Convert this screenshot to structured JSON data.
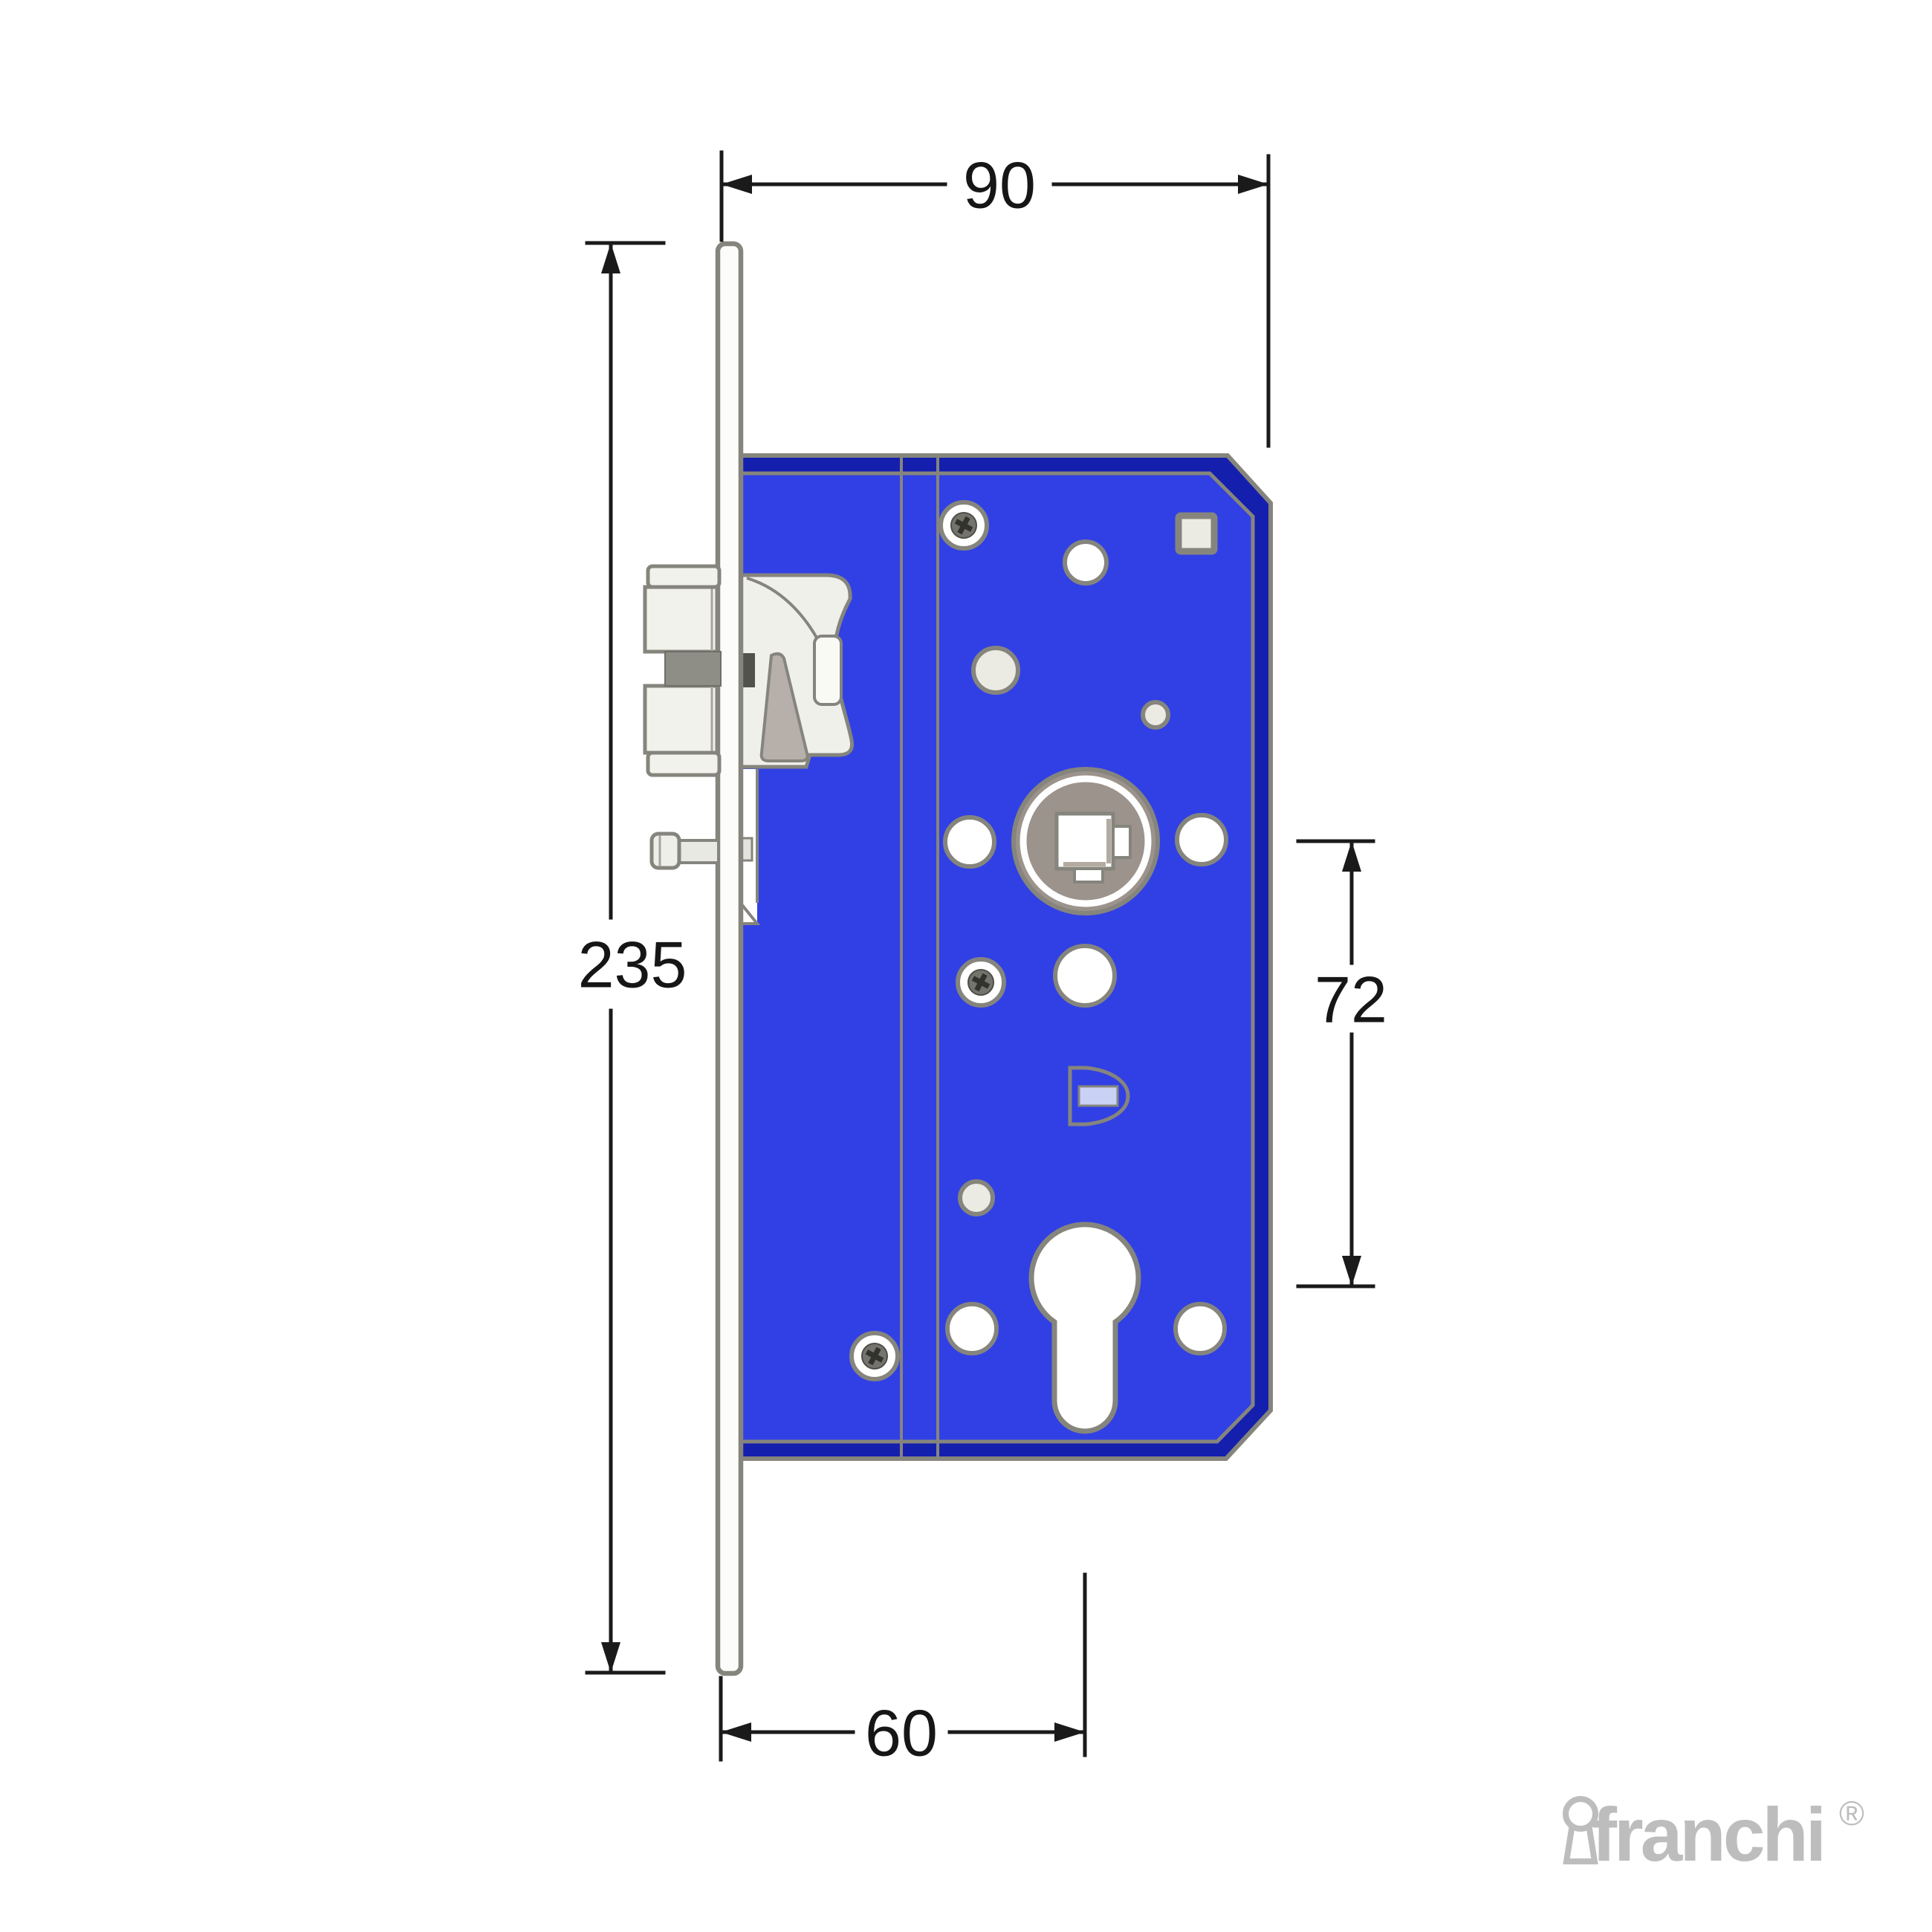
{
  "dims": {
    "width": "90",
    "height": "235",
    "centres": "72",
    "backset": "60"
  },
  "logo": {
    "text": "franchi",
    "registered": "®"
  },
  "colors": {
    "lock_body_blue": "#3140e4",
    "lock_body_edge_blue": "#151fae",
    "outline_gray": "#85857d",
    "part_light_gray": "#f2f2ec",
    "latch_recess_gray": "#8e8e86",
    "hub_taupe": "#9c938c",
    "spring_wedge_gray": "#b7afa9",
    "keep_slot_lavender": "#c9d2f5",
    "dimension_black": "#1a1a1a",
    "logo_gray": "#bdbdbd"
  }
}
